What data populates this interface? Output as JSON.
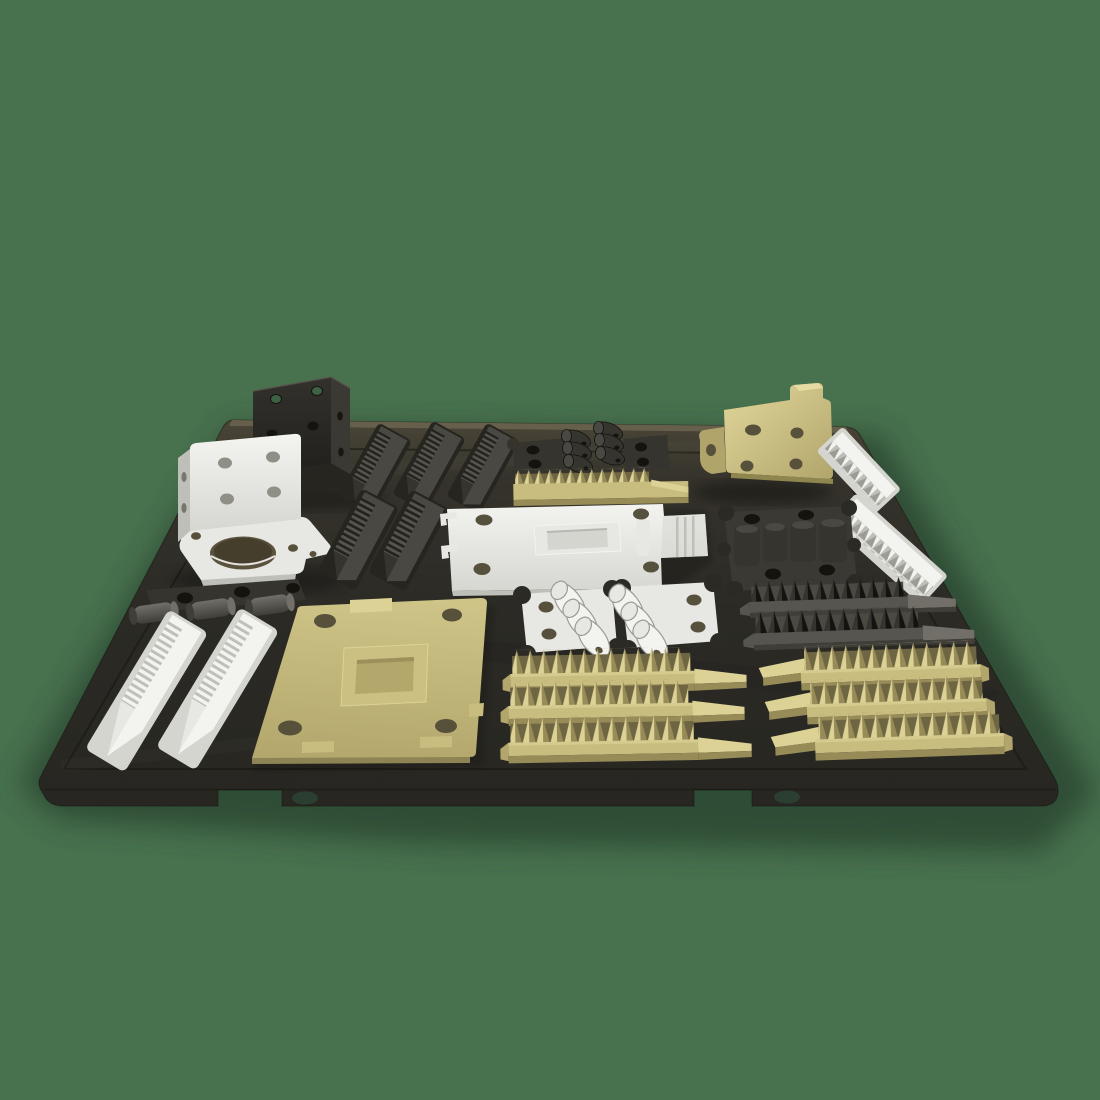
{
  "scene": {
    "title": "3D-printed parts laid out on a dark textured build plate",
    "background_color": "#48714E",
    "build_plate": {
      "name": "flexible textured print sheet",
      "color": "#2B2A25",
      "features": [
        "engraved inner border line",
        "two front edge notches",
        "two oval finger holes in front lip"
      ]
    },
    "parts": [
      {
        "name": "corner-bracket",
        "color_name": "black",
        "color_hex": "#34332E",
        "count": 1,
        "position": "back-left, standing upright, through-holes showing background"
      },
      {
        "name": "motor-mount-bracket",
        "color_name": "white",
        "color_hex": "#E7E7E3",
        "count": 1,
        "position": "back-left, large round bore in base"
      },
      {
        "name": "stepped-racks",
        "color_name": "dark-gray",
        "color_hex": "#403E39",
        "count": 5,
        "position": "back-left-center, three behind and two in front"
      },
      {
        "name": "hook-clips-with-plates",
        "color_name": "black",
        "color_hex": "#34332E",
        "count": 2,
        "position": "back-center, two plates and six curved clips"
      },
      {
        "name": "gear-rack",
        "color_name": "khaki",
        "color_hex": "#C8BC7F",
        "count": 1,
        "position": "back-center, fine teeth with smooth ramp end"
      },
      {
        "name": "motor-mount-bracket",
        "color_name": "khaki",
        "color_hex": "#C8BC7F",
        "count": 1,
        "position": "back-right, standing upright"
      },
      {
        "name": "toothed-racks",
        "color_name": "white",
        "color_hex": "#E7E7E3",
        "count": 2,
        "position": "right edge, angled with plate edge"
      },
      {
        "name": "base-plate-with-boss",
        "color_name": "white",
        "color_hex": "#E7E7E3",
        "count": 1,
        "position": "center, four corner holes, side clips"
      },
      {
        "name": "clamp-plate-with-blocks",
        "color_name": "black",
        "color_hex": "#34332E",
        "count": 1,
        "position": "center-right, scalloped corners, four holes"
      },
      {
        "name": "spike-combs",
        "color_name": "black",
        "color_hex": "#26251F",
        "count": 2,
        "position": "center-right, gray bases with dark spikes and ramp ends"
      },
      {
        "name": "hinge-rollers",
        "color_name": "dark-gray",
        "color_hex": "#57554F",
        "count": 3,
        "position": "middle-left, cylinders in front of holed plate"
      },
      {
        "name": "hook-clips-with-plates",
        "color_name": "white",
        "color_hex": "#E7E7E3",
        "count": 2,
        "position": "center-front, two plates and six curved clips"
      },
      {
        "name": "base-plate-with-boss",
        "color_name": "khaki",
        "color_hex": "#C8BC7F",
        "count": 1,
        "position": "front-left-center, four corner holes, edge tabs"
      },
      {
        "name": "stepped-racks",
        "color_name": "white",
        "color_hex": "#E7E7E3",
        "count": 2,
        "position": "front-left, long diagonal stair-step bars"
      },
      {
        "name": "spike-combs",
        "color_name": "khaki",
        "color_hex": "#C8BC7F",
        "count": 3,
        "position": "front-center, ramps pointing right"
      },
      {
        "name": "spike-combs",
        "color_name": "khaki",
        "color_hex": "#C8BC7F",
        "count": 3,
        "position": "front-right, ramps pointing left"
      }
    ]
  },
  "palette": {
    "bg_green": "#48714E",
    "bg_shadow": "#2C4632",
    "plate_top": "#4C4738",
    "plate_upper": "#35332B",
    "plate_mid": "#2B2A25",
    "plate_low": "#272621",
    "plate_bevel": "#6B644F",
    "plate_line": "#16150F",
    "hole_dark": "#14130E",
    "hole_green": "#3E6245",
    "oval_hole": "#2A3F30",
    "white_hi": "#F3F3F0",
    "white_mid": "#E7E7E3",
    "white_low": "#D5D5D0",
    "white_shade": "#BFBFB9",
    "white_dark": "#9C9C95",
    "khaki_hi": "#DDD296",
    "khaki_mid": "#C8BC7F",
    "khaki_low": "#B2A66C",
    "khaki_shade": "#978B58",
    "khaki_dark": "#6E6542",
    "khaki_hole": "#57503A",
    "black_hi": "#4A4843",
    "black_mid": "#36342F",
    "black_low": "#262520",
    "black_dark": "#141310",
    "gray_hi": "#716F68",
    "gray_mid": "#57554F",
    "gray_low": "#403E39",
    "step_g_hi": "#56544C",
    "step_g_lo": "#23221E"
  }
}
